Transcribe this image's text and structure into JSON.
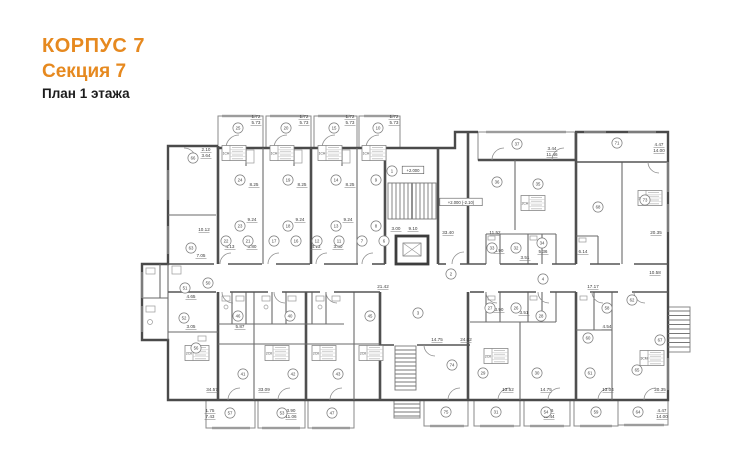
{
  "title": {
    "building": "КОРПУС 7",
    "section": "Секция 7",
    "floor": "План 1 этажа"
  },
  "colors": {
    "accent": "#E6891F",
    "wall": "#4A4A4A",
    "thin": "#8A8A8A",
    "text": "#3A3A3A"
  },
  "plan": {
    "rooms": [
      [
        "25",
        238,
        128
      ],
      [
        "20",
        286,
        128
      ],
      [
        "15",
        334,
        128
      ],
      [
        "10",
        378,
        128
      ],
      [
        "66",
        193,
        158
      ],
      [
        "63",
        191,
        248
      ],
      [
        "24",
        240,
        180
      ],
      [
        "19",
        288,
        180
      ],
      [
        "14",
        336,
        180
      ],
      [
        "9",
        376,
        180
      ],
      [
        "23",
        240,
        226
      ],
      [
        "18",
        288,
        226
      ],
      [
        "13",
        336,
        226
      ],
      [
        "8",
        376,
        226
      ],
      [
        "22",
        226,
        241
      ],
      [
        "21",
        248,
        241
      ],
      [
        "17",
        274,
        241
      ],
      [
        "16",
        296,
        241
      ],
      [
        "12",
        317,
        241
      ],
      [
        "11",
        339,
        241
      ],
      [
        "7",
        362,
        241
      ],
      [
        "6",
        384,
        241
      ],
      [
        "1",
        392,
        171
      ],
      [
        "2",
        451,
        274
      ],
      [
        "50",
        208,
        283
      ],
      [
        "51",
        185,
        288
      ],
      [
        "52",
        184,
        318
      ],
      [
        "56",
        196,
        348
      ],
      [
        "46",
        238,
        316
      ],
      [
        "40",
        290,
        316
      ],
      [
        "45",
        370,
        316
      ],
      [
        "41",
        243,
        374
      ],
      [
        "42",
        293,
        374
      ],
      [
        "43",
        338,
        374
      ],
      [
        "57",
        230,
        413
      ],
      [
        "53",
        282,
        413
      ],
      [
        "47",
        332,
        413
      ],
      [
        "3",
        418,
        313
      ],
      [
        "74",
        452,
        365
      ],
      [
        "33",
        492,
        248
      ],
      [
        "32",
        516,
        248
      ],
      [
        "34",
        542,
        243
      ],
      [
        "4",
        543,
        279
      ],
      [
        "27",
        490,
        308
      ],
      [
        "26",
        516,
        308
      ],
      [
        "28",
        541,
        316
      ],
      [
        "29",
        483,
        373
      ],
      [
        "30",
        537,
        373
      ],
      [
        "37",
        517,
        144
      ],
      [
        "36",
        497,
        182
      ],
      [
        "35",
        538,
        184
      ],
      [
        "71",
        617,
        143
      ],
      [
        "68",
        598,
        207
      ],
      [
        "73",
        645,
        200
      ],
      [
        "62",
        632,
        300
      ],
      [
        "58",
        607,
        308
      ],
      [
        "60",
        588,
        338
      ],
      [
        "67",
        660,
        340
      ],
      [
        "61",
        590,
        373
      ],
      [
        "65",
        637,
        370
      ],
      [
        "75",
        446,
        412
      ],
      [
        "31",
        496,
        412
      ],
      [
        "54",
        546,
        412
      ],
      [
        "59",
        596,
        412
      ],
      [
        "64",
        638,
        412
      ]
    ],
    "dimensions": [
      [
        "1.72",
        256,
        118
      ],
      [
        "5.73",
        256,
        124
      ],
      [
        "1.72",
        304,
        118
      ],
      [
        "5.73",
        304,
        124
      ],
      [
        "1.72",
        350,
        118
      ],
      [
        "5.73",
        350,
        124
      ],
      [
        "1.72",
        394,
        118
      ],
      [
        "5.73",
        394,
        124
      ],
      [
        "2.10",
        206,
        151
      ],
      [
        "3.64",
        206,
        157
      ],
      [
        "8.25",
        254,
        186
      ],
      [
        "8.25",
        302,
        186
      ],
      [
        "8.25",
        350,
        186
      ],
      [
        "9.24",
        252,
        221
      ],
      [
        "9.24",
        300,
        221
      ],
      [
        "9.24",
        348,
        221
      ],
      [
        "4.13",
        230,
        248
      ],
      [
        "3.80",
        252,
        248
      ],
      [
        "4.13",
        316,
        248
      ],
      [
        "3.80",
        338,
        248
      ],
      [
        "10.12",
        204,
        231
      ],
      [
        "7.05",
        201,
        257
      ],
      [
        "4.65",
        191,
        298
      ],
      [
        "3.05",
        191,
        328
      ],
      [
        "5.87",
        240,
        328
      ],
      [
        "34.57",
        212,
        391
      ],
      [
        "33.09",
        264,
        391
      ],
      [
        "1.75",
        210,
        412
      ],
      [
        "7.43",
        210,
        418
      ],
      [
        "3.90",
        291,
        412
      ],
      [
        "11.06",
        291,
        418
      ],
      [
        "21.42",
        383,
        288
      ],
      [
        "9.10",
        413,
        230
      ],
      [
        "3.00",
        396,
        230
      ],
      [
        "33.40",
        448,
        234
      ],
      [
        "11.52",
        495,
        234
      ],
      [
        "3.90",
        499,
        252
      ],
      [
        "5.36",
        543,
        253
      ],
      [
        "3.51",
        525,
        259
      ],
      [
        "3.90",
        499,
        311
      ],
      [
        "3.51",
        524,
        314
      ],
      [
        "14.75",
        437,
        341
      ],
      [
        "24.02",
        466,
        341
      ],
      [
        "13.52",
        508,
        391
      ],
      [
        "14.75",
        546,
        391
      ],
      [
        "3.44",
        552,
        150
      ],
      [
        "11.46",
        552,
        156
      ],
      [
        "6.14",
        583,
        253
      ],
      [
        "17.17",
        593,
        288
      ],
      [
        "10.58",
        655,
        274
      ],
      [
        "20.35",
        656,
        234
      ],
      [
        "4.54",
        607,
        328
      ],
      [
        "13.04",
        608,
        391
      ],
      [
        "20.35",
        660,
        391
      ],
      [
        "4.47",
        659,
        146
      ],
      [
        "14.00",
        659,
        152
      ],
      [
        "3.46",
        549,
        412
      ],
      [
        "11.44",
        549,
        418
      ],
      [
        "4.47",
        662,
        412
      ],
      [
        "14.00",
        662,
        418
      ]
    ],
    "tables": [
      [
        "1СН",
        234,
        153
      ],
      [
        "1СН",
        282,
        153
      ],
      [
        "1СН",
        330,
        153
      ],
      [
        "1СН",
        374,
        153
      ],
      [
        "2СН",
        533,
        203
      ],
      [
        "3СМ",
        650,
        198
      ],
      [
        "2СК",
        197,
        353
      ],
      [
        "2СК",
        277,
        353
      ],
      [
        "2СК",
        324,
        353
      ],
      [
        "2СК",
        371,
        353
      ],
      [
        "2СК",
        496,
        356
      ],
      [
        "3СМ",
        652,
        358
      ]
    ],
    "levels": [
      [
        "+2.000",
        413,
        171
      ],
      [
        "+2.000 (-2.10)",
        461,
        203
      ]
    ]
  }
}
